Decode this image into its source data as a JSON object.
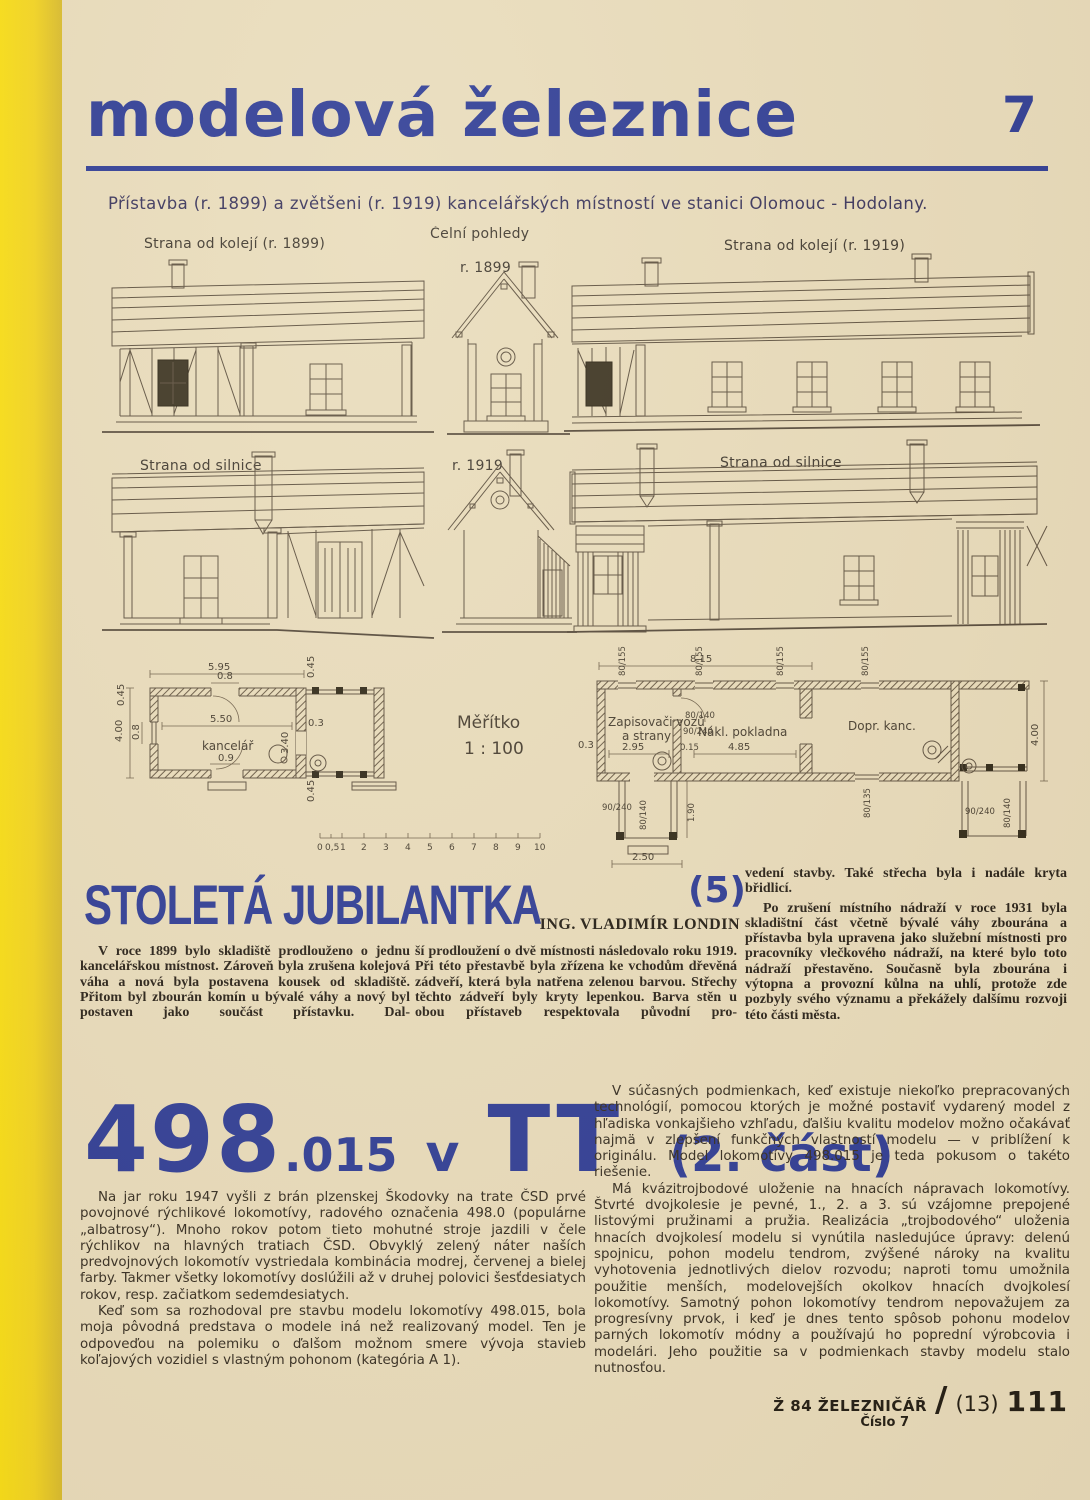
{
  "page": {
    "number": "7",
    "accent_blue": "#2d3b96",
    "paper": "#e9dcbc"
  },
  "header": {
    "title": "modelová železnice"
  },
  "caption": "Přístavba (r. 1899) a zvětšeni (r. 1919) kancelářských místností ve stanici Olomouc - Hodolany.",
  "drawings": {
    "labels": {
      "track_1899": "Strana od kolejí (r. 1899)",
      "front_views": "Čelní pohledy",
      "front_1899": "r. 1899",
      "track_1919": "Strana od kolejí (r. 1919)",
      "road_1899": "Strana od silnice",
      "front_1919": "r. 1919",
      "road_1919": "Strana od silnice"
    },
    "plans": {
      "left": {
        "room": "kancelář",
        "dims": [
          "5.95",
          "0.8",
          "0.45",
          "0.45",
          "4.00",
          "0.8",
          "5.50",
          "0.3",
          "3.40",
          "0.9",
          "0.45"
        ]
      },
      "scale": {
        "title": "Měřítko",
        "ratio": "1 : 100",
        "ticks": [
          "0",
          "0,5",
          "1",
          "2",
          "3",
          "4",
          "5",
          "6",
          "7",
          "8",
          "9",
          "10"
        ]
      },
      "right": {
        "room1_line1": "Zapisovači vozů",
        "room1_line2": "a strany",
        "room2": "Nákl. pokladna",
        "room3": "Dopr. kanc.",
        "dims": [
          "8.15",
          "4.00",
          "0.3",
          "2.95",
          "0.15",
          "4.85",
          "80/155",
          "80/140",
          "90/240",
          "1.90",
          "2.50",
          "80/135",
          "80/140",
          "90/240"
        ]
      }
    }
  },
  "article1": {
    "title": "STOLETÁ JUBILANTKA",
    "part": "(5)",
    "author": "ING. VLADIMÍR LONDIN",
    "col1": "V roce 1899 bylo skladiště prodlouženo o jednu kancelářskou místnost. Zároveň byla zrušena kolejová váha a nová byla postavena kousek od skladiště. Přitom byl zbourán komín u bývalé váhy a nový byl postaven jako součást přístavku. Dal-",
    "col2": "ší prodloužení o dvě místnosti následovalo roku 1919. Při této přestavbě byla zřízena ke vchodům dřevěná zádveří, která byla natřena zelenou barvou. Střechy těchto zádveří byly kryty lepenkou. Barva stěn u obou přístaveb respektovala původní pro-",
    "col3_p1": "vedení stavby. Také střecha byla i nadále kryta břidlicí.",
    "col3_p2": "Po zrušení místního nádraží v roce 1931 byla skladištní část včetně bývalé váhy zbourána a přístavba byla upravena jako služební místnosti pro pracovníky vlečkového nádraží, na které bylo toto nádraží přestavěno. Současně byla zbourána i výtopna a provozní kůlna na uhlí, protože zde pozbyly svého významu a překážely dalšímu rozvoji této části města."
  },
  "article2": {
    "title_num": "498",
    "title_sub": ".015",
    "title_v": "v",
    "title_tt": "TT",
    "title_part": "(2. část)",
    "left_p1": "Na jar roku 1947 vyšli z brán plzenskej Škodovky na trate ČSD prvé povojnové rýchlikové lokomotívy, radového označenia 498.0 (populárne „albatrosy“). Mnoho rokov potom tieto mohutné stroje jazdili v čele rýchlikov na hlavných tratiach ČSD. Obvyklý zelený náter naších predvojnových lokomotív vystriedala kombinácia modrej, červenej a bielej farby. Takmer všetky lokomotívy doslúžili až v druhej polovici šesťdesiatych rokov, resp. začiatkom sedemdesiatych.",
    "left_p2": "Keď som sa rozhodoval pre stavbu modelu lokomotívy 498.015, bola moja pôvodná predstava o modele iná než realizovaný model. Ten je odpoveďou na polemiku o ďalšom možnom smere vývoja stavieb koľajových vozidiel s vlastným pohonom (kategória A 1).",
    "right_p1": "V súčasných podmienkach, keď existuje niekoľko prepracovaných technológií, pomocou ktorých je možné postaviť vydarený model z hľadiska vonkajšieho vzhľadu, ďalšiu kvalitu modelov možno očakávať najmä v zlepšení funkčných vlastností modelu — v priblížení k originálu. Model lokomotívy 498.015 je teda pokusom o takéto riešenie.",
    "right_p2": "Má kvázitrojbodové uloženie na hnacích nápravach lokomotívy. Štvrté dvojkolesie je pevné, 1., 2. a 3. sú vzájomne prepojené listovými pružinami a pružia. Realizácia „trojbodového“ uloženia hnacích dvojkolesí modelu si vynútila nasledujúce úpravy: delenú spojnicu, pohon modelu tendrom, zvýšené nároky na kvalitu vyhotovenia jednotlivých dielov rozvodu; naproti tomu umožnila použitie menších, modelovejších okolkov hnacích dvojkolesí lokomotívy. Samotný pohon lokomotívy tendrom nepovažujem za progresívny prvok, i keď je dnes tento spôsob pohonu modelov parných lokomotív módny a používajú ho poprední výrobcovia i modelári. Jeho použitie sa v podmienkach stavby modelu stalo nutnosťou."
  },
  "footer": {
    "imprint": "Ž 84 ŽELEZNIČÁŘ",
    "issue_label": "Číslo 7",
    "slash": "/",
    "series": "(13)",
    "page": "111"
  }
}
